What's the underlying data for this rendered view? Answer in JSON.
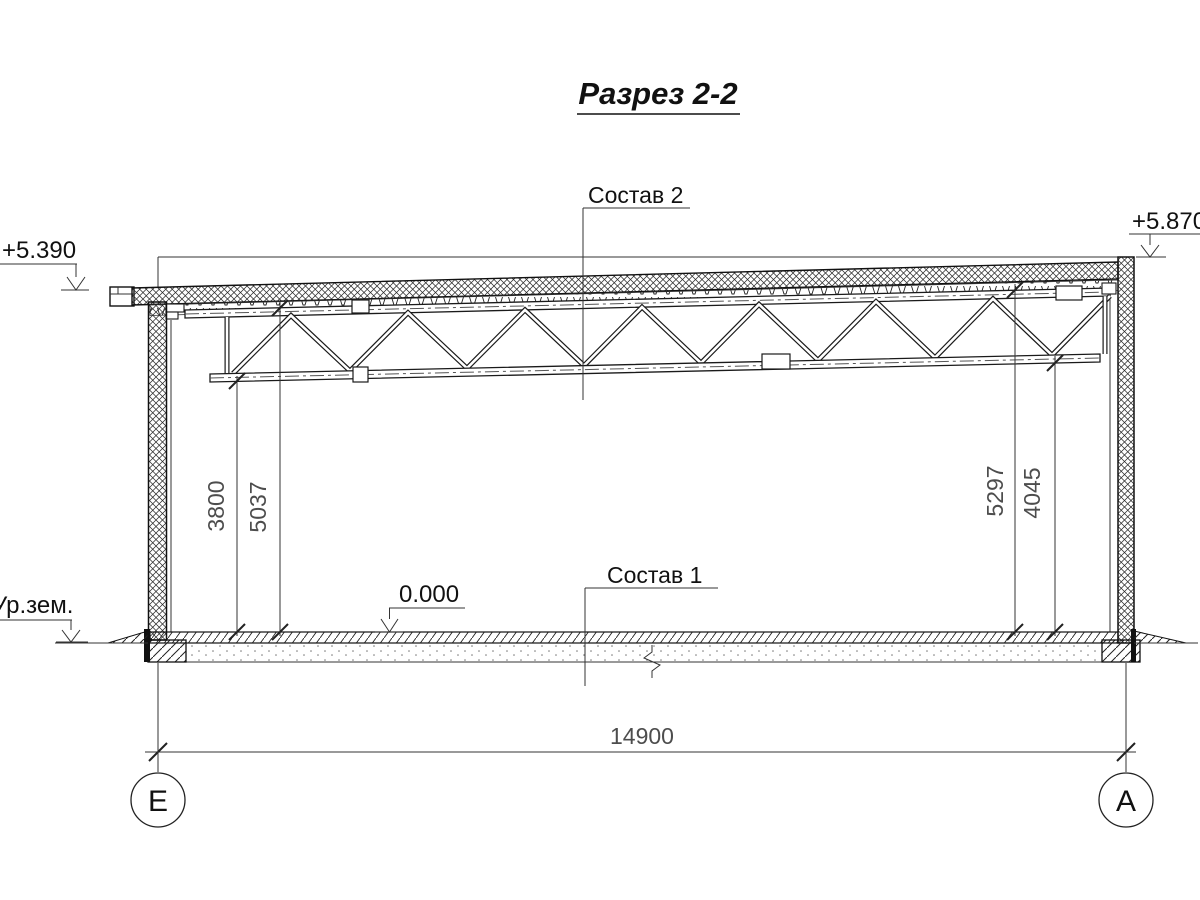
{
  "drawing": {
    "title": "Разрез 2-2",
    "callouts": {
      "roof": "Состав 2",
      "floor": "Состав 1"
    },
    "elevations": {
      "roof_left": "+5.390",
      "roof_right": "+5.870",
      "floor": "0.000",
      "ground": "Ур.зем."
    },
    "dimensions": {
      "left_to_bottom_chord": "3800",
      "left_to_top_chord": "5037",
      "right_to_top_chord": "5297",
      "right_to_bottom_chord": "4045",
      "span": "14900"
    },
    "axes": {
      "left": "Е",
      "right": "А"
    },
    "colors": {
      "line": "#1a1a1a",
      "dim_text": "#4d4d4d",
      "background": "#ffffff"
    }
  }
}
